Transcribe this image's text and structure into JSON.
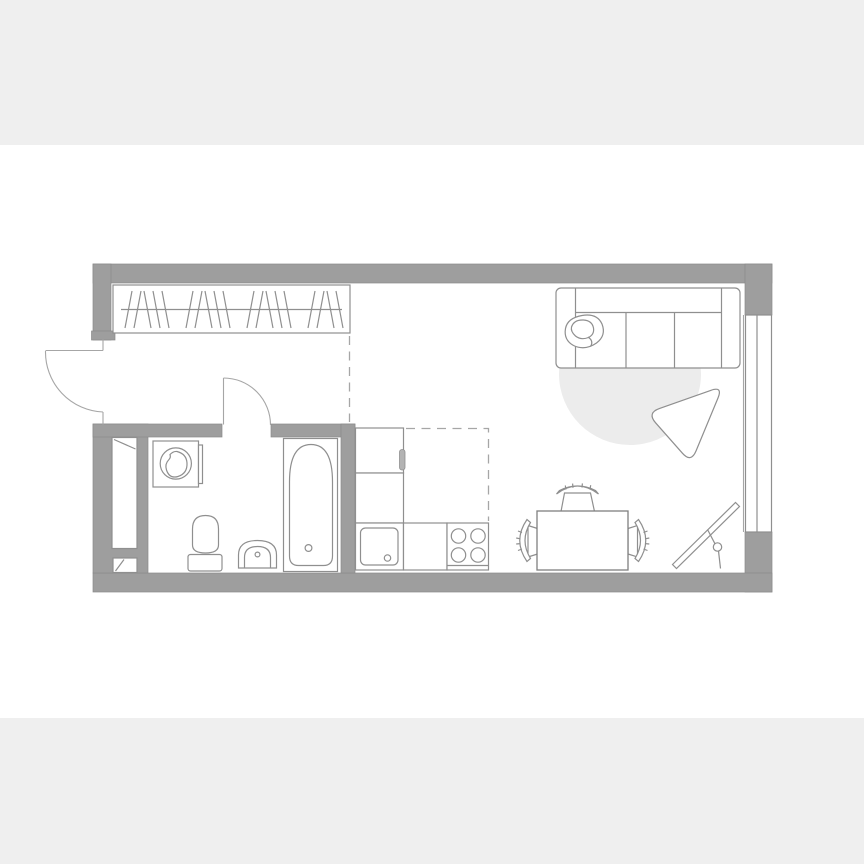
{
  "page": {
    "kind": "apartment-floor-plan-image",
    "background": "#ffffff",
    "band_color": "#efefef"
  },
  "palette": {
    "white": "#ffffff",
    "band": "#efefef",
    "wall": "#9e9e9e",
    "wallStroke": "#8a8a8a",
    "line": "#8f8f8f",
    "lineDark": "#7f7f7f",
    "lineLight": "#a6a6a6",
    "rug": "#ececec",
    "handle": "#b3b3b3"
  },
  "floorplan": {
    "type": "studio-apartment",
    "rooms": [
      {
        "name": "hallway"
      },
      {
        "name": "bathroom"
      },
      {
        "name": "kitchen-zone"
      },
      {
        "name": "living-dining-zone"
      }
    ],
    "elements": [
      "entrance-door",
      "bathroom-door",
      "wardrobe",
      "ventilation-shaft",
      "washing-machine",
      "toilet",
      "wash-basin",
      "bathtub",
      "tall-cabinet",
      "base-cabinet",
      "kitchen-sink",
      "cooktop",
      "dining-table",
      "chair-left",
      "chair-top",
      "chair-right",
      "sofa",
      "pillow",
      "round-rug",
      "lounge-chair",
      "floor-mirror",
      "window"
    ],
    "wardrobe": {
      "rail": {
        "x1": 121,
        "x2": 342,
        "y": 309.5
      },
      "hanger_groups": [
        2,
        3,
        2,
        3,
        2,
        3,
        2,
        2
      ],
      "hanger_top_y": 291,
      "hanger_bottom_y": 328,
      "hanger_slant": 7,
      "hanger_step": 9,
      "group_gap": 8,
      "start_x": 125
    },
    "cooktop_burners": [
      {
        "cx": 458.5,
        "cy": 536
      },
      {
        "cx": 478,
        "cy": 536
      },
      {
        "cx": 458.5,
        "cy": 555
      },
      {
        "cx": 478,
        "cy": 555
      }
    ],
    "burner_radius": 7.2
  }
}
